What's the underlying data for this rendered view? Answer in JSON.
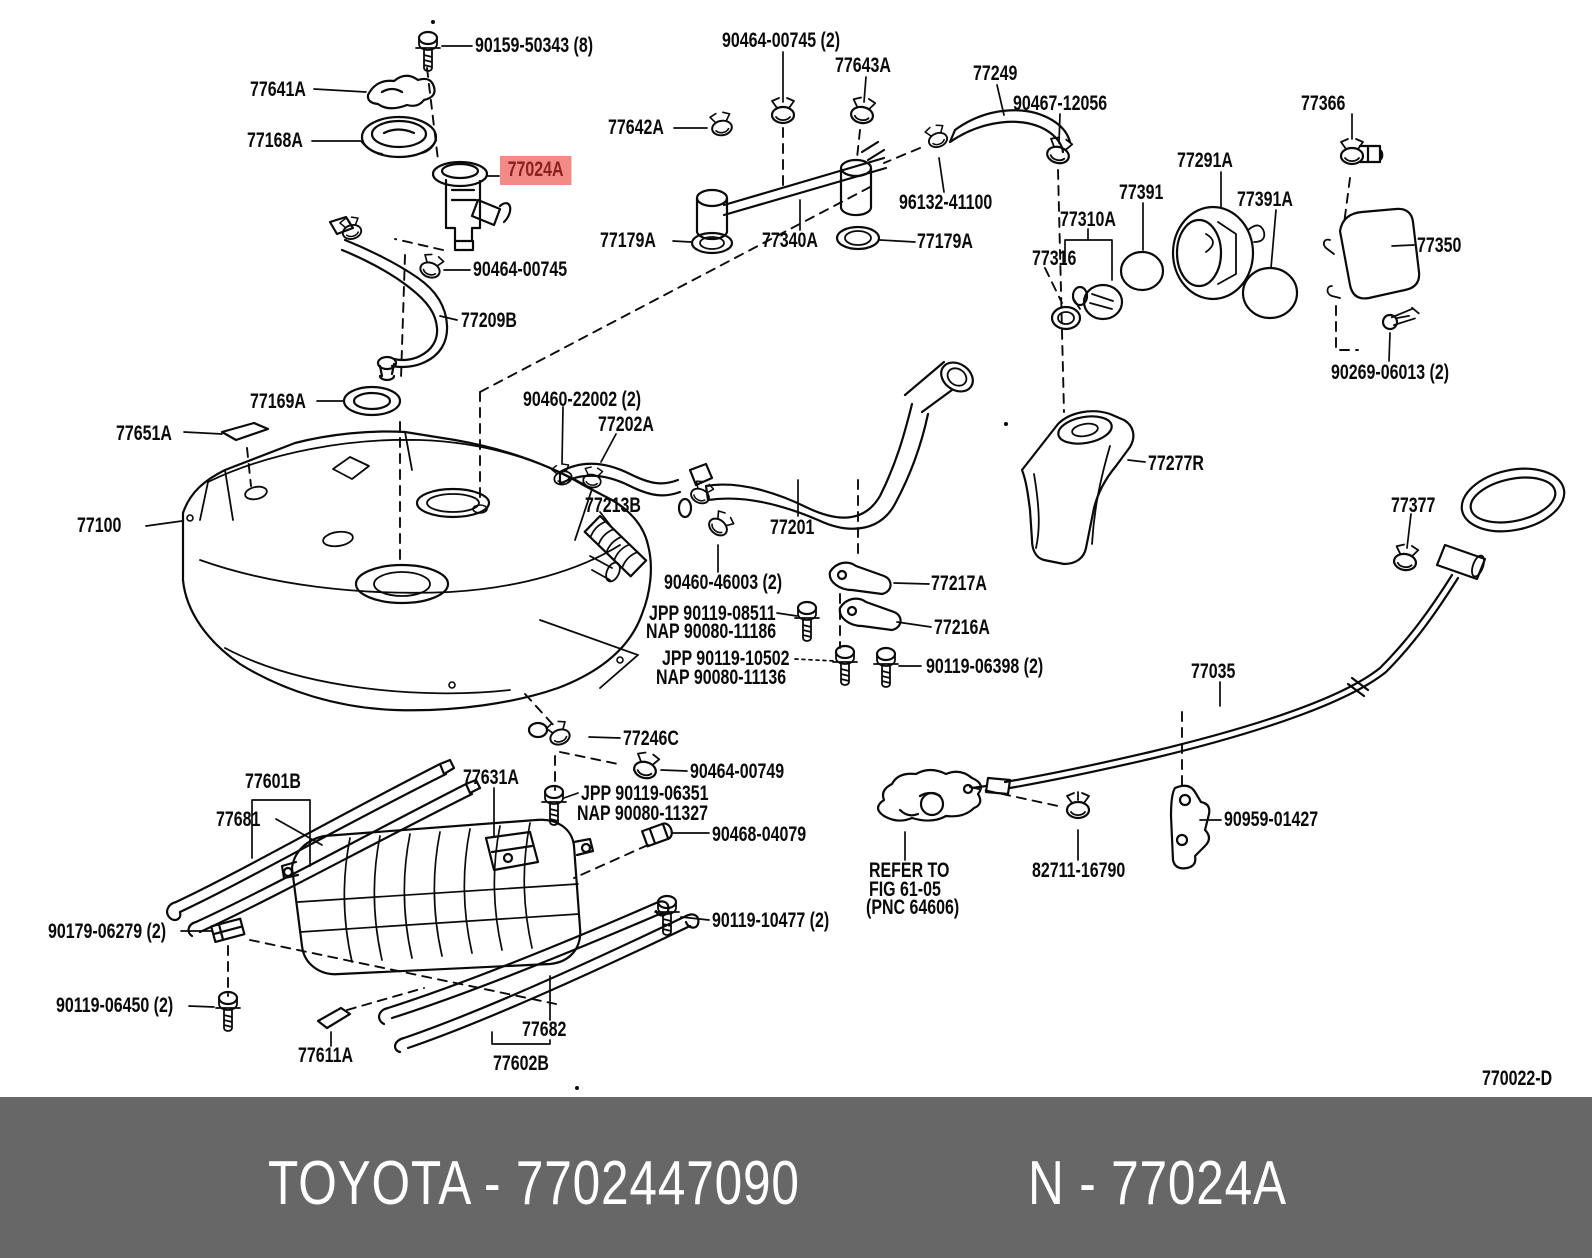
{
  "page": {
    "background": "#ffffff",
    "type": "toyota-parts-catalog-diagram",
    "subject": "fuel tank and tube"
  },
  "diagram": {
    "code": "770022-D",
    "highlight_color": "#f28b86",
    "highlight_text_color": "#8b1f1f",
    "line_color": "#0a0a0a",
    "labels": [
      {
        "name": "part-label-90159-50343",
        "text": "90159-50343 (8)",
        "x": 475,
        "y": 37,
        "interactable": true
      },
      {
        "name": "part-label-77641a",
        "text": "77641A",
        "x": 250,
        "y": 81,
        "interactable": true
      },
      {
        "name": "part-label-77168a",
        "text": "77168A",
        "x": 247,
        "y": 132,
        "interactable": true
      },
      {
        "name": "part-label-77024a-highlighted",
        "text": "77024A",
        "x": 500,
        "y": 156,
        "highlight": true,
        "interactable": true
      },
      {
        "name": "part-label-90464-00745-2",
        "text": "90464-00745 (2)",
        "x": 722,
        "y": 32,
        "interactable": true
      },
      {
        "name": "part-label-77643a",
        "text": "77643A",
        "x": 835,
        "y": 57,
        "interactable": true
      },
      {
        "name": "part-label-77642a",
        "text": "77642A",
        "x": 608,
        "y": 119,
        "interactable": true
      },
      {
        "name": "part-label-77249",
        "text": "77249",
        "x": 973,
        "y": 65,
        "interactable": true
      },
      {
        "name": "part-label-90467-12056",
        "text": "90467-12056",
        "x": 1013,
        "y": 95,
        "interactable": true
      },
      {
        "name": "part-label-96132-41100",
        "text": "96132-41100",
        "x": 899,
        "y": 194,
        "interactable": true
      },
      {
        "name": "part-label-77179a-left",
        "text": "77179A",
        "x": 600,
        "y": 232,
        "interactable": true
      },
      {
        "name": "part-label-77340a",
        "text": "77340A",
        "x": 762,
        "y": 232,
        "interactable": true
      },
      {
        "name": "part-label-77179a-right",
        "text": "77179A",
        "x": 917,
        "y": 233,
        "interactable": true
      },
      {
        "name": "part-label-77366",
        "text": "77366",
        "x": 1301,
        "y": 95,
        "interactable": true
      },
      {
        "name": "part-label-77291a",
        "text": "77291A",
        "x": 1177,
        "y": 152,
        "interactable": true
      },
      {
        "name": "part-label-77391",
        "text": "77391",
        "x": 1119,
        "y": 184,
        "interactable": true
      },
      {
        "name": "part-label-77391a",
        "text": "77391A",
        "x": 1237,
        "y": 191,
        "interactable": true
      },
      {
        "name": "part-label-77310a",
        "text": "77310A",
        "x": 1060,
        "y": 211,
        "interactable": true
      },
      {
        "name": "part-label-77316",
        "text": "77316",
        "x": 1032,
        "y": 250,
        "interactable": true
      },
      {
        "name": "part-label-77350",
        "text": "77350",
        "x": 1417,
        "y": 237,
        "interactable": true
      },
      {
        "name": "part-label-90269-06013-2",
        "text": "90269-06013 (2)",
        "x": 1331,
        "y": 364,
        "interactable": true
      },
      {
        "name": "part-label-90464-00745",
        "text": "90464-00745",
        "x": 473,
        "y": 261,
        "interactable": true
      },
      {
        "name": "part-label-77209b",
        "text": "77209B",
        "x": 461,
        "y": 312,
        "interactable": true
      },
      {
        "name": "part-label-77169a",
        "text": "77169A",
        "x": 250,
        "y": 393,
        "interactable": true
      },
      {
        "name": "part-label-77651a",
        "text": "77651A",
        "x": 116,
        "y": 425,
        "interactable": true
      },
      {
        "name": "part-label-90460-22002-2",
        "text": "90460-22002 (2)",
        "x": 523,
        "y": 391,
        "interactable": true
      },
      {
        "name": "part-label-77202a",
        "text": "77202A",
        "x": 598,
        "y": 416,
        "interactable": true
      },
      {
        "name": "part-label-77213b",
        "text": "77213B",
        "x": 585,
        "y": 497,
        "interactable": true
      },
      {
        "name": "part-label-77201",
        "text": "77201",
        "x": 770,
        "y": 519,
        "interactable": true
      },
      {
        "name": "part-label-77277r",
        "text": "77277R",
        "x": 1148,
        "y": 455,
        "interactable": true
      },
      {
        "name": "part-label-77100",
        "text": "77100",
        "x": 77,
        "y": 517,
        "interactable": true
      },
      {
        "name": "part-label-77377",
        "text": "77377",
        "x": 1391,
        "y": 497,
        "interactable": true
      },
      {
        "name": "part-label-90460-46003-2",
        "text": "90460-46003 (2)",
        "x": 664,
        "y": 574,
        "interactable": true
      },
      {
        "name": "part-label-77217a",
        "text": "77217A",
        "x": 931,
        "y": 575,
        "interactable": true
      },
      {
        "name": "part-label-jpp-90119-08511",
        "text": "JPP 90119-08511",
        "x": 649,
        "y": 605,
        "interactable": true
      },
      {
        "name": "part-label-nap-90080-11186",
        "text": "NAP 90080-11186",
        "x": 646,
        "y": 623,
        "interactable": true
      },
      {
        "name": "part-label-77216a",
        "text": "77216A",
        "x": 934,
        "y": 619,
        "interactable": true
      },
      {
        "name": "part-label-jpp-90119-10502",
        "text": "JPP 90119-10502",
        "x": 662,
        "y": 650,
        "interactable": true
      },
      {
        "name": "part-label-nap-90080-11136",
        "text": "NAP 90080-11136",
        "x": 656,
        "y": 669,
        "interactable": true
      },
      {
        "name": "part-label-90119-06398-2",
        "text": "90119-06398 (2)",
        "x": 926,
        "y": 658,
        "interactable": true
      },
      {
        "name": "part-label-77035",
        "text": "77035",
        "x": 1191,
        "y": 663,
        "interactable": true
      },
      {
        "name": "part-label-77246c",
        "text": "77246C",
        "x": 623,
        "y": 730,
        "interactable": true
      },
      {
        "name": "part-label-90464-00749",
        "text": "90464-00749",
        "x": 690,
        "y": 763,
        "interactable": true
      },
      {
        "name": "part-label-jpp-90119-06351",
        "text": "JPP 90119-06351",
        "x": 581,
        "y": 785,
        "interactable": true
      },
      {
        "name": "part-label-nap-90080-11327",
        "text": "NAP 90080-11327",
        "x": 577,
        "y": 805,
        "interactable": true
      },
      {
        "name": "part-label-90468-04079",
        "text": "90468-04079",
        "x": 712,
        "y": 826,
        "interactable": true
      },
      {
        "name": "part-label-77601b",
        "text": "77601B",
        "x": 245,
        "y": 773,
        "interactable": true
      },
      {
        "name": "part-label-77681",
        "text": "77681",
        "x": 216,
        "y": 811,
        "interactable": true
      },
      {
        "name": "part-label-77631a",
        "text": "77631A",
        "x": 463,
        "y": 769,
        "interactable": true
      },
      {
        "name": "part-label-90179-06279-2",
        "text": "90179-06279 (2)",
        "x": 48,
        "y": 923,
        "interactable": true
      },
      {
        "name": "part-label-90119-06450-2",
        "text": "90119-06450 (2)",
        "x": 56,
        "y": 997,
        "interactable": true
      },
      {
        "name": "part-label-77611a",
        "text": "77611A",
        "x": 298,
        "y": 1047,
        "interactable": true
      },
      {
        "name": "part-label-77682",
        "text": "77682",
        "x": 522,
        "y": 1021,
        "interactable": true
      },
      {
        "name": "part-label-77602b",
        "text": "77602B",
        "x": 493,
        "y": 1055,
        "interactable": true
      },
      {
        "name": "part-label-90119-10477-2",
        "text": "90119-10477 (2)",
        "x": 712,
        "y": 912,
        "interactable": true
      },
      {
        "name": "refer-note-line-1",
        "text": "REFER TO",
        "x": 869,
        "y": 862,
        "interactable": false
      },
      {
        "name": "refer-note-line-2",
        "text": "FIG 61-05",
        "x": 869,
        "y": 881,
        "interactable": false
      },
      {
        "name": "refer-note-line-3",
        "text": "(PNC 64606)",
        "x": 866,
        "y": 899,
        "interactable": false
      },
      {
        "name": "part-label-82711-16790",
        "text": "82711-16790",
        "x": 1032,
        "y": 862,
        "interactable": true
      },
      {
        "name": "part-label-90959-01427",
        "text": "90959-01427",
        "x": 1224,
        "y": 811,
        "interactable": true
      },
      {
        "name": "diagram-code",
        "text": "770022-D",
        "x": 1482,
        "y": 1070,
        "interactable": false
      }
    ]
  },
  "footer": {
    "background": "#676767",
    "text_color": "#ffffff",
    "left": "TOYOTA - 7702447090",
    "right": "N - 77024A"
  }
}
